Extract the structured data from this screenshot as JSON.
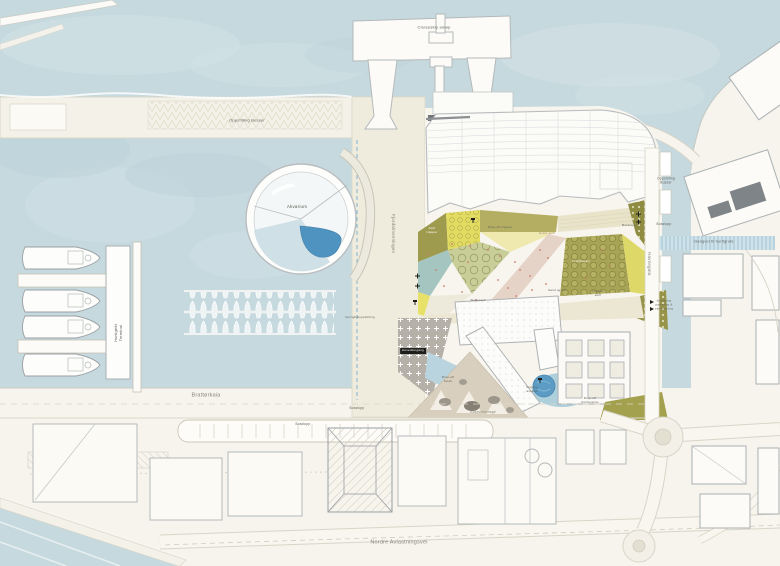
{
  "colors": {
    "water": "#c6d9df",
    "land": "#f6f4ed",
    "quay": "#f3f1e8",
    "olive": "#a8a455",
    "olive_dark": "#8f8c42",
    "yellow": "#e3dc62",
    "teal": "#a5c6c0",
    "pool_blue": "#4f93c0",
    "canal_blue": "#b9d4de",
    "plaza_gray": "#b5b0a8"
  },
  "waterfront": {
    "cruise_berth": "Cruiseskip anløp",
    "bus_staging": "Oppstilling Busser",
    "aquarium": "Akvarium",
    "ferry_terminal": "Hurtigbåt\nTerminal",
    "ferry_staging": "Hurtigbåtoppstilling"
  },
  "streets": {
    "fjordalmenningen": "Fjordalmenningen",
    "brattorkaia": "Brattørkaia",
    "havnegata": "Havnegata",
    "nordre_avlastningsvei": "Nordre Avlastningsvei",
    "bus_stop_a": "Busstopp",
    "bus_stop_b": "Busstopp",
    "bus_stop_right": "Busstopp",
    "bus_staging_right": "Oppstilling\nBusser",
    "walkway_hurtigrute": "Gangvei til hurtigrute",
    "parking_entrance": "Innkjøring\nparkering &\nvarelevering"
  },
  "park": {
    "amphi_steps": "Amfi\ntrapper",
    "dropoff_steps": "Drop-off trapper",
    "green_amphi": "Grønt amfi",
    "bus_stop": "Busstopp",
    "orchard": "Frukthagen",
    "sand_play": "Sand og lek",
    "skate": "Skatepark",
    "view_amphi": "Utsikts-\namfi"
  },
  "buildings": {
    "main_entrance": "Hovedinngang",
    "dropoff_hotel": "Drop-off\nhotell",
    "staff_entrance": "Inngang\nansatte",
    "dropoff_conference": "Drop-off\nKonferanse",
    "boulder_garden": "Rullesteinshage"
  }
}
